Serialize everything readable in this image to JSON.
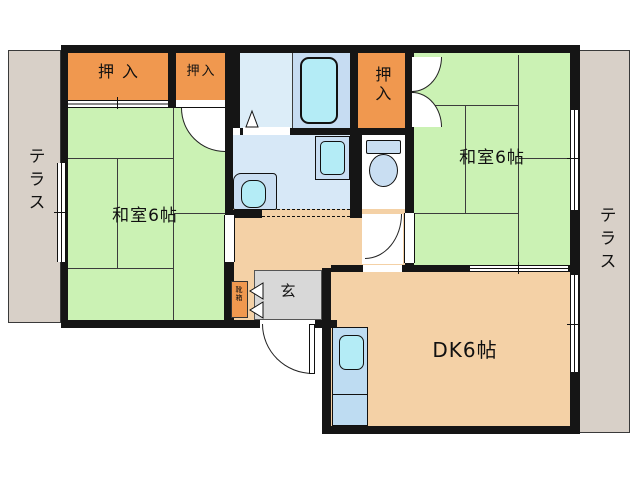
{
  "rooms": {
    "washitsu_left": {
      "label": "和室6帖",
      "type": "japanese-room-6-tatami"
    },
    "washitsu_right": {
      "label": "和室6帖",
      "type": "japanese-room-6-tatami"
    },
    "dk": {
      "label": "DK6帖",
      "type": "dining-kitchen-6-tatami"
    },
    "genkan": {
      "label": "玄",
      "type": "entrance-hall"
    },
    "closet_top_left": {
      "label": "押入",
      "type": "futon-closet"
    },
    "closet_top_mid": {
      "label": "押入",
      "type": "futon-closet"
    },
    "closet_top_right": {
      "label": "押入",
      "type": "futon-closet"
    },
    "shoe_cabinet": {
      "label": "靴箱",
      "type": "shoe-cabinet"
    },
    "terrace_left": {
      "label": "テラス",
      "type": "terrace"
    },
    "terrace_right": {
      "label": "テラス",
      "type": "terrace"
    }
  },
  "fixtures": [
    "bathtub",
    "bathroom-door-triangle",
    "washbasin",
    "washing-machine-pan",
    "toilet",
    "kitchen-sink-unit",
    "entrance-door",
    "shoe-cabinet-doors",
    "closet-double-doors",
    "sliding-doors",
    "windows"
  ],
  "colors": {
    "tatami_green": "#cbf2b4",
    "closet_orange": "#f0984f",
    "floor_tan": "#f4d1a6",
    "genkan_gray": "#d8d8d8",
    "terrace_gray": "#d8d0c8",
    "bath_pale": "#dcedf8",
    "bath_blue": "#c6dcf2",
    "washroom_blue": "#d7e8f7",
    "fixture_blue": "#c9def2",
    "fixture_cyan": "#b4ecf6",
    "kitchen_blue": "#bedcf2",
    "wall_black": "#151515"
  }
}
